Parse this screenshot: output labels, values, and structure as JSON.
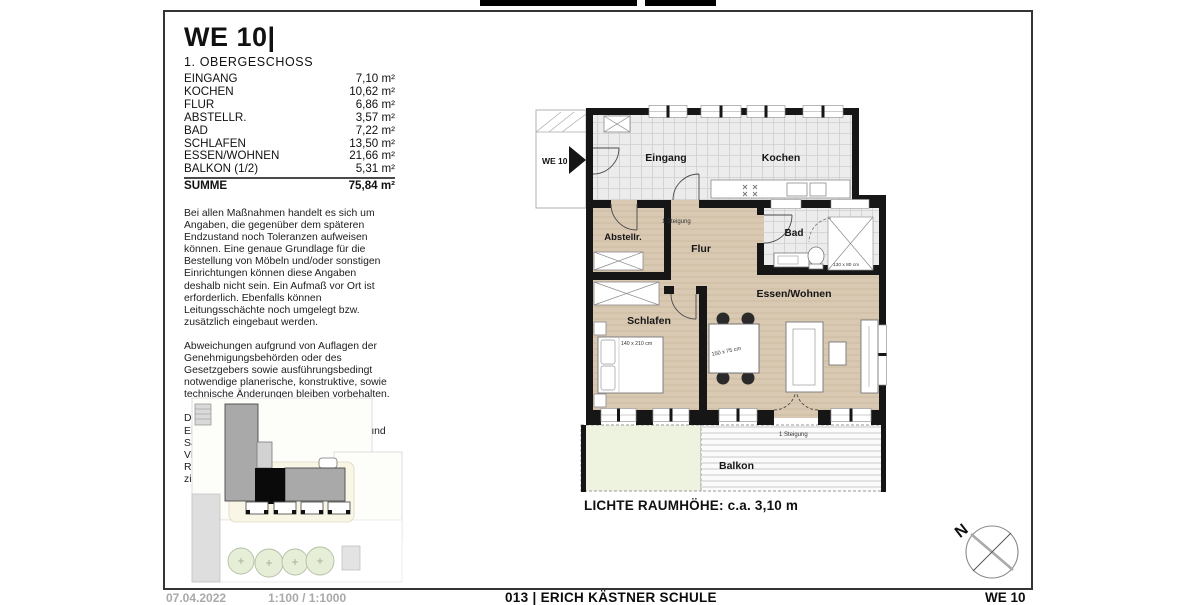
{
  "header": {
    "title": "WE 10|",
    "subtitle": "1. OBERGESCHOSS"
  },
  "areas": {
    "rows": [
      {
        "label": "EINGANG",
        "value": "7,10 m²"
      },
      {
        "label": "KOCHEN",
        "value": "10,62 m²"
      },
      {
        "label": "FLUR",
        "value": "6,86 m²"
      },
      {
        "label": "ABSTELLR.",
        "value": "3,57 m²"
      },
      {
        "label": "BAD",
        "value": "7,22 m²"
      },
      {
        "label": "SCHLAFEN",
        "value": "13,50 m²"
      },
      {
        "label": "ESSEN/WOHNEN",
        "value": "21,66 m²"
      },
      {
        "label": "BALKON (1/2)",
        "value": "5,31 m²"
      }
    ],
    "total": {
      "label": "SUMME",
      "value": "75,84 m²"
    }
  },
  "disclaimer": {
    "p1": "Bei allen Maßnahmen handelt es sich um Angaben, die gegenüber dem späteren Endzustand noch Toleranzen aufweisen können. Eine genaue Grundlage für die Bestellung von Möbeln und/oder sonstigen Einrichtungen können diese Angaben deshalb nicht sein. Ein Aufmaß vor Ort ist erforderlich. Ebenfalls können Leitungsschächte noch umgelegt bzw. zusätzlich eingebaut werden.",
    "p2": "Abweichungen aufgrund von Auflagen der Genehmigungsbehörden oder des Gesetzgebers sowie ausführungsbedingt notwendige planerische, konstruktive, sowie technische Änderungen bleiben vorbehalten.",
    "p3": "Die dargestellten Möbel, Einrichtungsgegenstände,Bodenbeläge und Sanitärobjekte dienen ausschließlich der Visualisierung. Es lassen sich keine Rückschlüsse auf sonstige Installationen ziehen."
  },
  "plan": {
    "unit_label": "WE 10",
    "rooms": {
      "eingang": "Eingang",
      "kochen": "Kochen",
      "abstellraum": "Abstellr.",
      "flur": "Flur",
      "bad": "Bad",
      "schlafen": "Schlafen",
      "essen_wohnen": "Essen/Wohnen",
      "balkon": "Balkon"
    },
    "annotations": {
      "steigung_flur": "1 Steigung",
      "steigung_balkon": "1 Steigung",
      "bed_size": "140 x 210 cm",
      "table_size": "150 x 75 cm",
      "shower_size": "130 x 80 cm",
      "room_height": "LICHTE RAUMHÖHE: c.a. 3,10 m"
    },
    "compass_north": "N"
  },
  "footer": {
    "left_date": "07.04.2022",
    "left_scale": "1:100 / 1:1000",
    "center": "013 | ERICH KÄSTNER SCHULE",
    "right": "WE 10"
  },
  "colors": {
    "wood": "#d9c8b2",
    "tile": "#ececec",
    "wall": "#161616",
    "green": "#edf3df",
    "accent_black": "#000000"
  }
}
